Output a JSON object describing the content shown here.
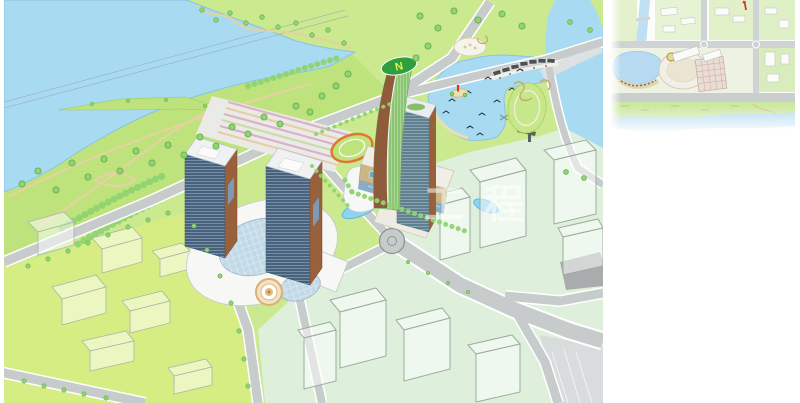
{
  "image": {
    "kind": "architectural-masterplan-aerial-rendering",
    "canvas": {
      "width": 800,
      "height": 403
    },
    "regions": {
      "main_rendering": "isometric aerial view of riverside mixed-use complex with twin towers, sail hotel tower, lake and park",
      "inset": "top-right small site location plan with red tick marker"
    }
  },
  "watermark": {
    "text": "工程"
  },
  "helipad": {
    "label": "N"
  },
  "palette": {
    "water": "#A8DAF2",
    "water_edge": "#8CC2E0",
    "lawn": "#CBE98F",
    "lawn_bright": "#D6ED83",
    "park": "#BFE37C",
    "mint": "#DEF0DC",
    "road": "#C7CBCB",
    "road_line": "#8E9496",
    "tree": "#8FD470",
    "tree_dark": "#63AB4F",
    "path_tan": "#E4D2A0",
    "pool": "#8FD3EE",
    "ghost_fill": "rgba(255,255,255,0.5)",
    "ghost_stroke": "#A9B6A4",
    "glass_blue": "#46627E",
    "glass_slab": "#5E8090",
    "terracotta": "#99603C",
    "sail_brown": "#8E5B3B",
    "sail_green": "#8CC573",
    "helipad_green": "#2E9E3F",
    "helipad_text": "#E6EF4F",
    "court_green": "#2E8F7A",
    "court_border": "#B5432E",
    "tan_facade": "#C9B788",
    "white_building": "#F7F8F5",
    "dome_glass": "#C2D9E8",
    "dark_roof": "#4A5258",
    "red_marker": "#E03022"
  }
}
